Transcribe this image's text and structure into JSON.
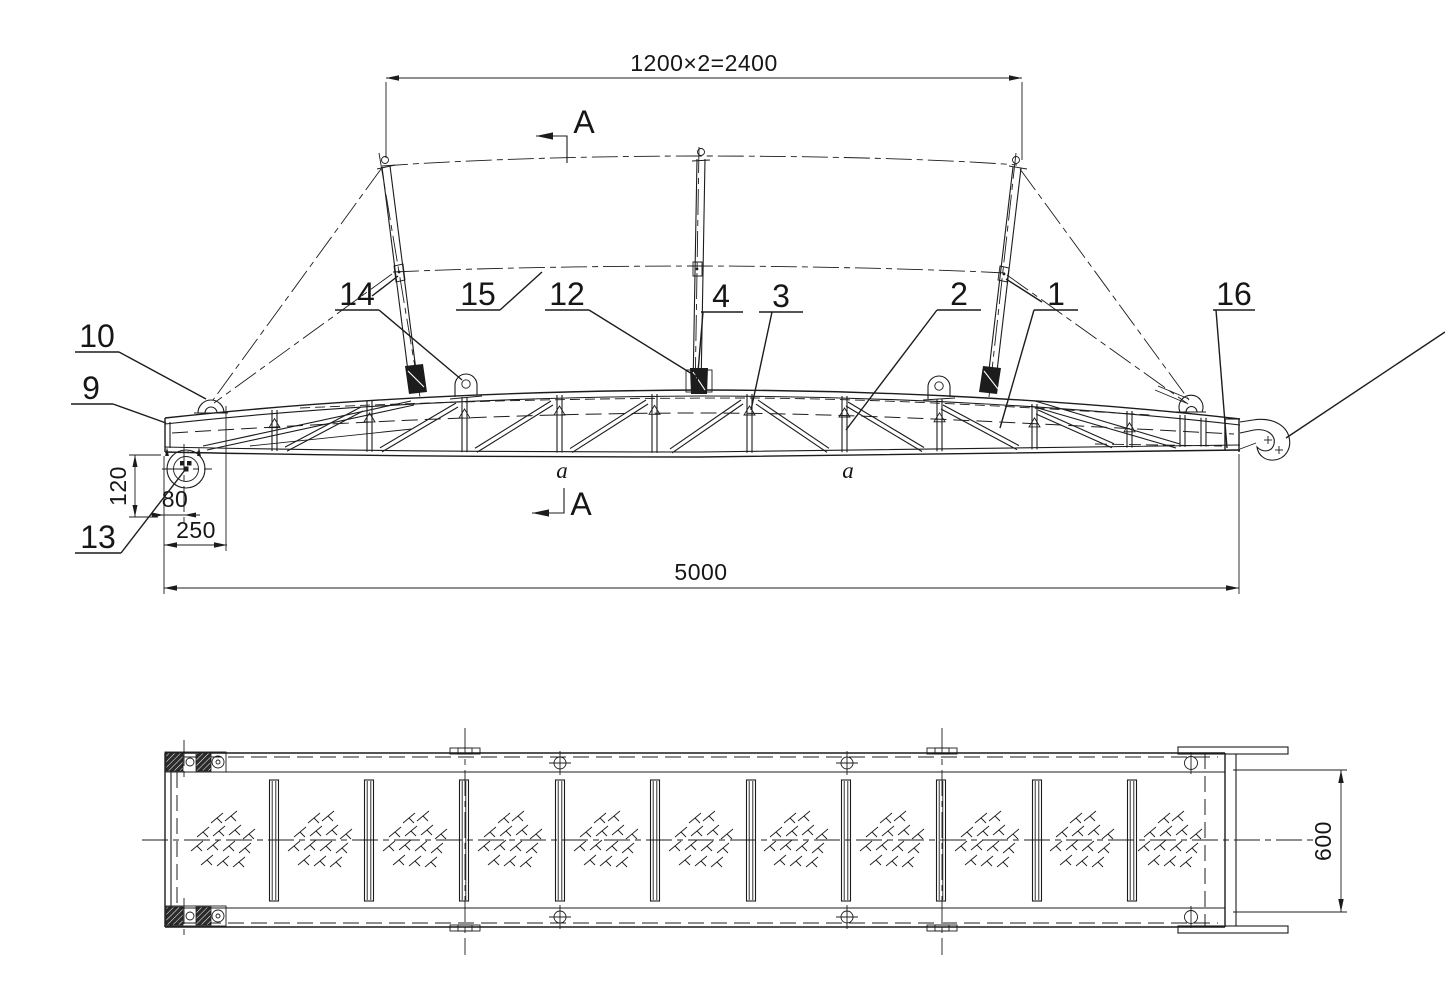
{
  "section": {
    "letter": "A"
  },
  "weld": {
    "mark": "a"
  },
  "dimensions": {
    "top_span": "1200×2=2400",
    "overall_length": "5000",
    "nose_length": "250",
    "roller_offset": "80",
    "roller_drop": "120",
    "width": "600"
  },
  "part_labels": {
    "p1": "1",
    "p2": "2",
    "p3": "3",
    "p4": "4",
    "p9": "9",
    "p10": "10",
    "p12": "12",
    "p13": "13",
    "p14": "14",
    "p15": "15",
    "p16": "16"
  },
  "colors": {
    "line": "#1c1c1c",
    "background": "#ffffff"
  }
}
